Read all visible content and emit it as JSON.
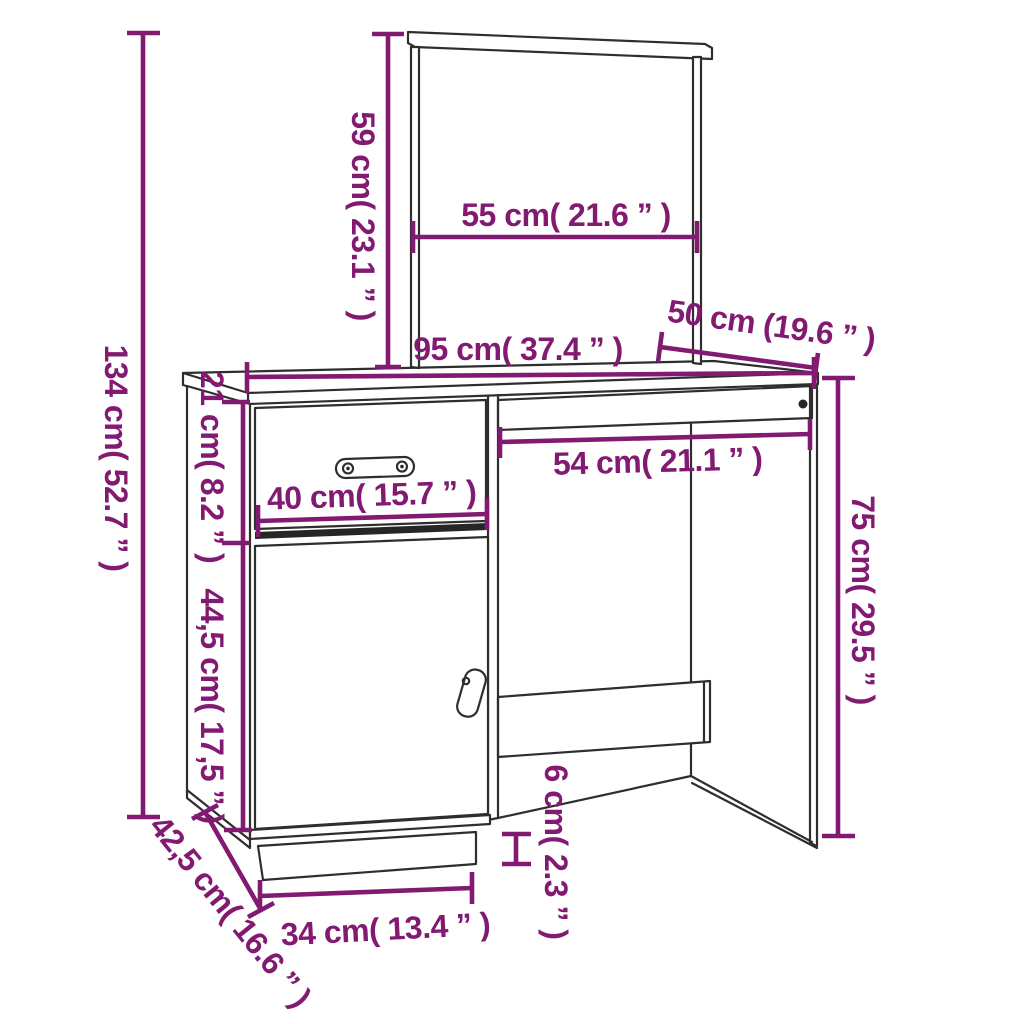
{
  "diagram": {
    "kind": "furniture-dimension-diagram",
    "subject": "dressing table with mirror, drawer, cabinet door and side panel",
    "colors": {
      "dimension_accent": "#821A72",
      "line_art": "#2e2e2e",
      "background": "#ffffff"
    }
  },
  "labels": {
    "total_height": "134 cm( 52.7 ” )",
    "mirror_height": "59 cm( 23.1 ” )",
    "mirror_width": "55 cm( 21.6 ” )",
    "desktop_width": "95 cm( 37.4 ” )",
    "desktop_depth": "50 cm (19.6 ” )",
    "drawer_height": "21 cm( 8.2 ” )",
    "drawer_width": "40 cm( 15.7 ” )",
    "knee_space_width": "54 cm( 21.1 ” )",
    "door_height": "44,5 cm( 17,5 ” )",
    "under_top_height": "75 cm( 29.5 ” )",
    "base_depth": "42,5 cm( 16.6 ” )",
    "plinth_width": "34 cm( 13.4 ” )",
    "plinth_height": "6 cm( 2.3 ” )"
  }
}
